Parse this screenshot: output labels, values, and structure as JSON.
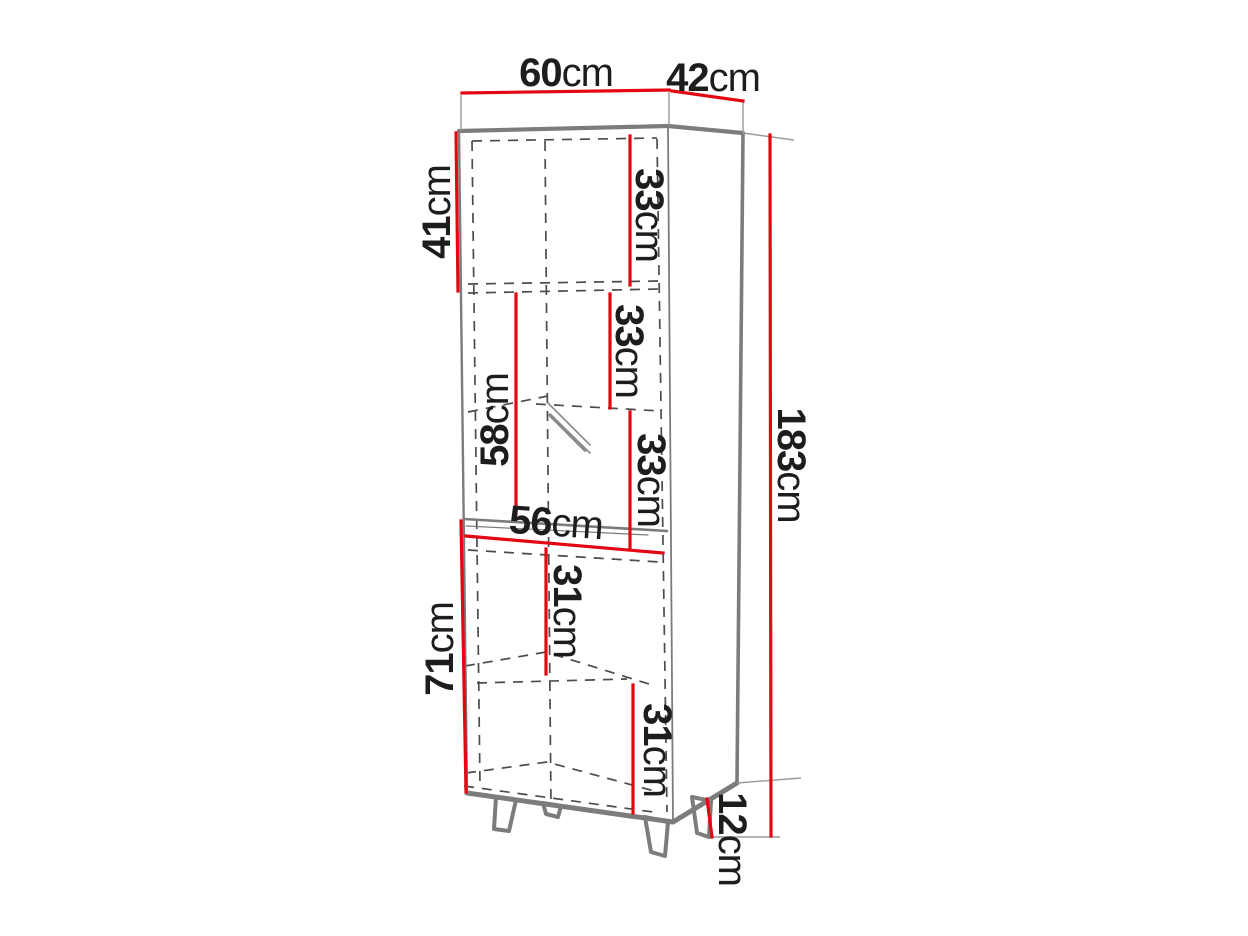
{
  "diagram": {
    "type": "furniture-dimension-drawing",
    "subject": "tall-display-cabinet-with-legs",
    "colors": {
      "dimension_line": "#e30613",
      "outline": "#7c7c7c",
      "hidden_line": "#4c4c4c",
      "extension_line": "#9a9a9a",
      "text": "#1d1d1d",
      "background": "#ffffff"
    }
  },
  "dimensions": [
    {
      "id": "overall-width",
      "value": "60",
      "unit": "cm"
    },
    {
      "id": "overall-depth",
      "value": "42",
      "unit": "cm"
    },
    {
      "id": "top-section-height",
      "value": "41",
      "unit": "cm"
    },
    {
      "id": "top-shelf-spacing",
      "value": "33",
      "unit": "cm"
    },
    {
      "id": "glass-shelf-spacing-upper",
      "value": "33",
      "unit": "cm"
    },
    {
      "id": "glass-section-height",
      "value": "58",
      "unit": "cm"
    },
    {
      "id": "glass-shelf-spacing-lower",
      "value": "33",
      "unit": "cm"
    },
    {
      "id": "interior-width",
      "value": "56",
      "unit": "cm"
    },
    {
      "id": "lower-shelf-spacing-upper",
      "value": "31",
      "unit": "cm"
    },
    {
      "id": "lower-section-height",
      "value": "71",
      "unit": "cm"
    },
    {
      "id": "lower-shelf-spacing-lower",
      "value": "31",
      "unit": "cm"
    },
    {
      "id": "overall-height",
      "value": "183",
      "unit": "cm"
    },
    {
      "id": "leg-height",
      "value": "12",
      "unit": "cm"
    }
  ]
}
